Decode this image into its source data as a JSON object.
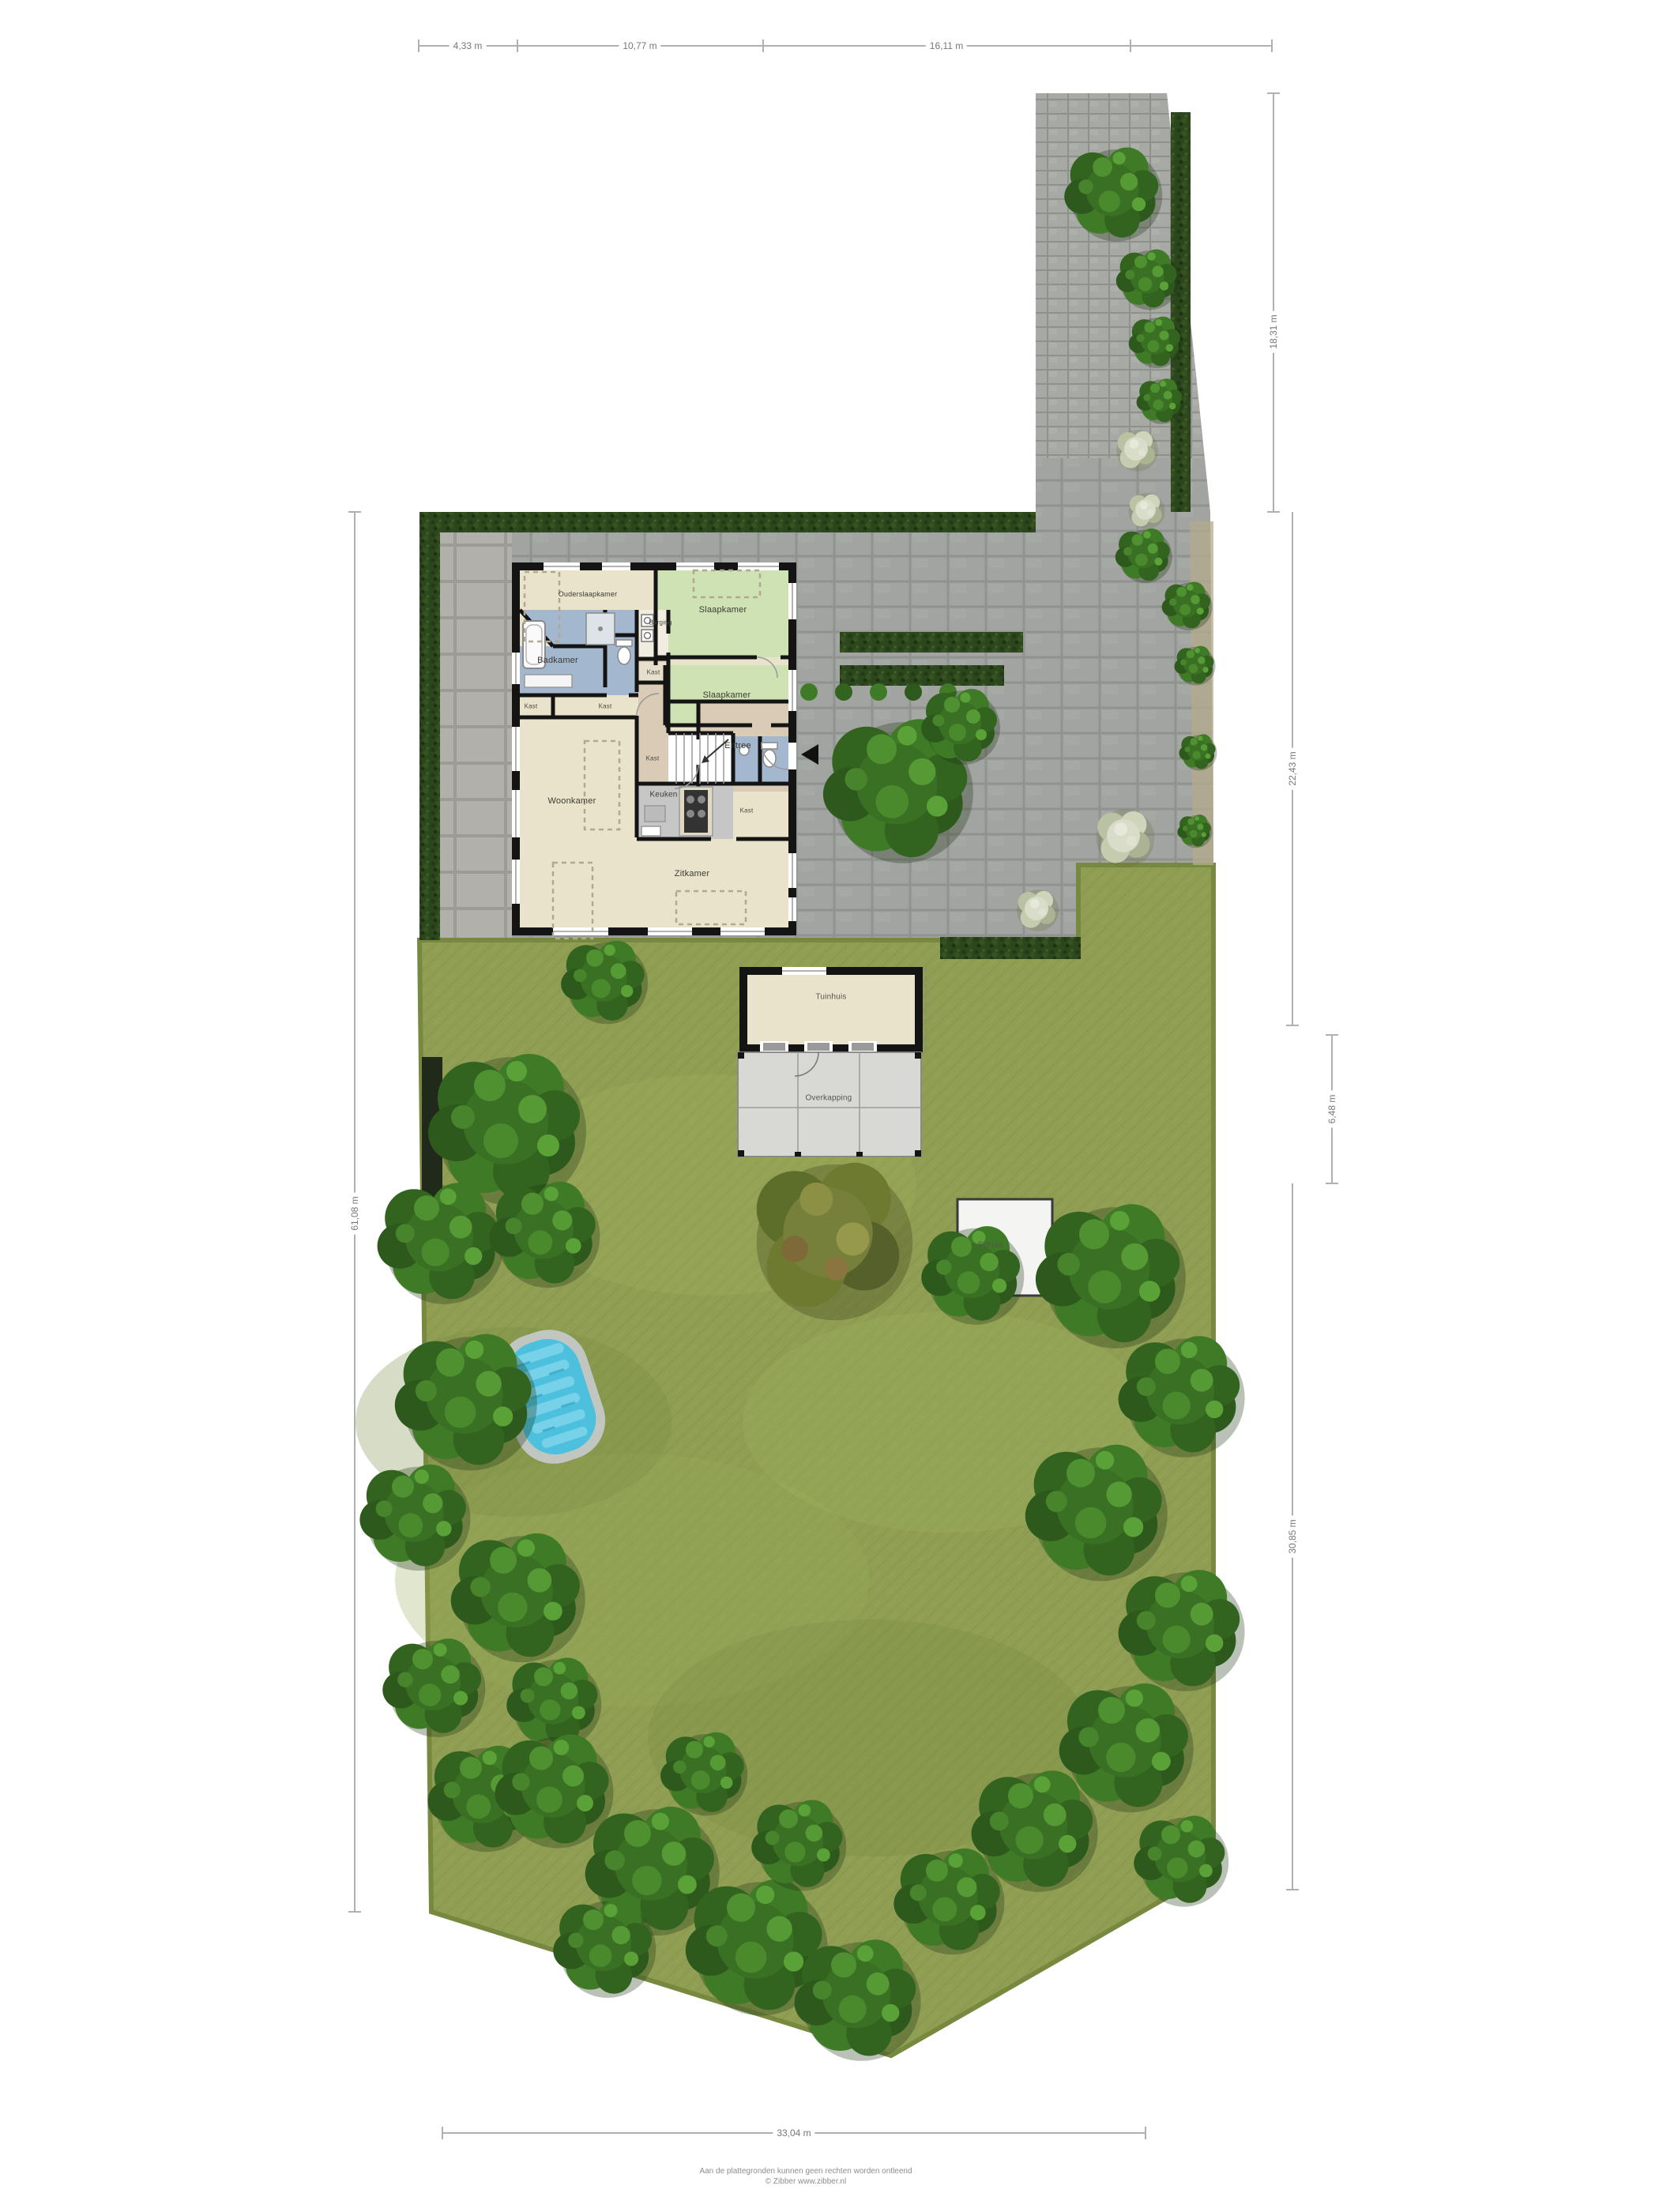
{
  "dimensions": {
    "top": [
      "4,33 m",
      "10,77 m",
      "16,11 m"
    ],
    "right": [
      "18,31 m",
      "22,43 m",
      "6,48 m",
      "30,85 m"
    ],
    "left": "61,08 m",
    "bottom": "33,04 m"
  },
  "house": {
    "rooms": {
      "ouderslaapkamer": "Ouderslaapkamer",
      "slaapkamer": "Slaapkamer",
      "badkamer": "Badkamer",
      "berging": "Berging",
      "kast": "Kast",
      "entree": "Entree",
      "keuken": "Keuken",
      "woonkamer": "Woonkamer",
      "zitkamer": "Zitkamer"
    }
  },
  "garden": {
    "tuinhuis": "Tuinhuis",
    "overkapping": "Overkapping",
    "schuur": "Schuur"
  },
  "footer": {
    "line1": "Aan de plattegronden kunnen geen rechten worden ontleend",
    "line2": "© Zibber www.zibber.nl"
  },
  "colors": {
    "lawn": "#8f9e52",
    "pavement": "#a1a4a0",
    "hedge": "#2c471d",
    "bedroom_green": "#cfe2b4",
    "bathroom_blue": "#a3b8cf",
    "hall_tan": "#d9cbb5",
    "floor_beige": "#eae3cc",
    "pool_water": "#4cc0dd",
    "wall": "#141414"
  }
}
